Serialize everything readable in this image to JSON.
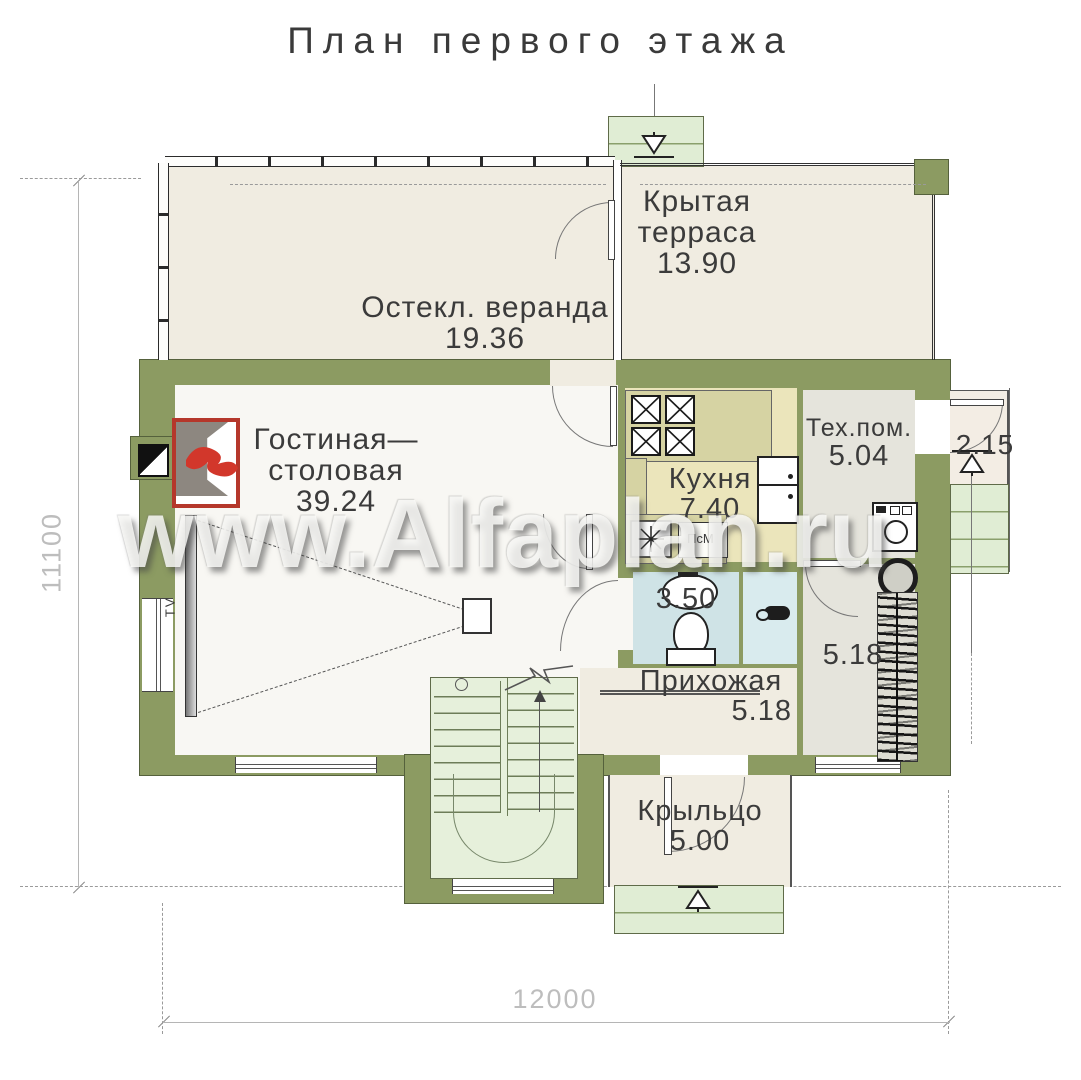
{
  "title": "План первого этажа",
  "watermark": "www.Alfaplan.ru",
  "rooms": {
    "terrace": {
      "line1": "Крытая",
      "line2": "терраса",
      "area": "13.90"
    },
    "veranda": {
      "line1": "Остекл. веранда",
      "area": "19.36"
    },
    "living": {
      "line1": "Гостиная—",
      "line2": "столовая",
      "area": "39.24"
    },
    "kitchen": {
      "line1": "Кухня",
      "area": "7.40"
    },
    "tech": {
      "line1": "Тех.пом.",
      "area": "5.04"
    },
    "bathroom": {
      "area": "3.50"
    },
    "corridor": {
      "area": "5.18"
    },
    "hallway": {
      "line1": "Прихожая",
      "area": "5.18"
    },
    "entry_porch": {
      "line1": "Крыльцо",
      "area": "5.00"
    },
    "side_porch": {
      "area": "2.15"
    }
  },
  "small_labels": {
    "dishwasher": "ПсМ",
    "tv": "TV"
  },
  "dimensions": {
    "bottom": "12000",
    "left": "11100"
  },
  "colors": {
    "wall": "#8c9b62",
    "floor_cream": "#f0ece1",
    "floor_living": "#f8f7f3",
    "floor_kitchen": "#ebe5bb",
    "floor_utility": "#e5e4dc",
    "floor_bath": "#cfe3e6",
    "steps_green": "#e0edd4",
    "furniture_green": "#b7c3a9",
    "fireplace_red": "#b5372b",
    "deckchair_orange": "#d89a50"
  }
}
